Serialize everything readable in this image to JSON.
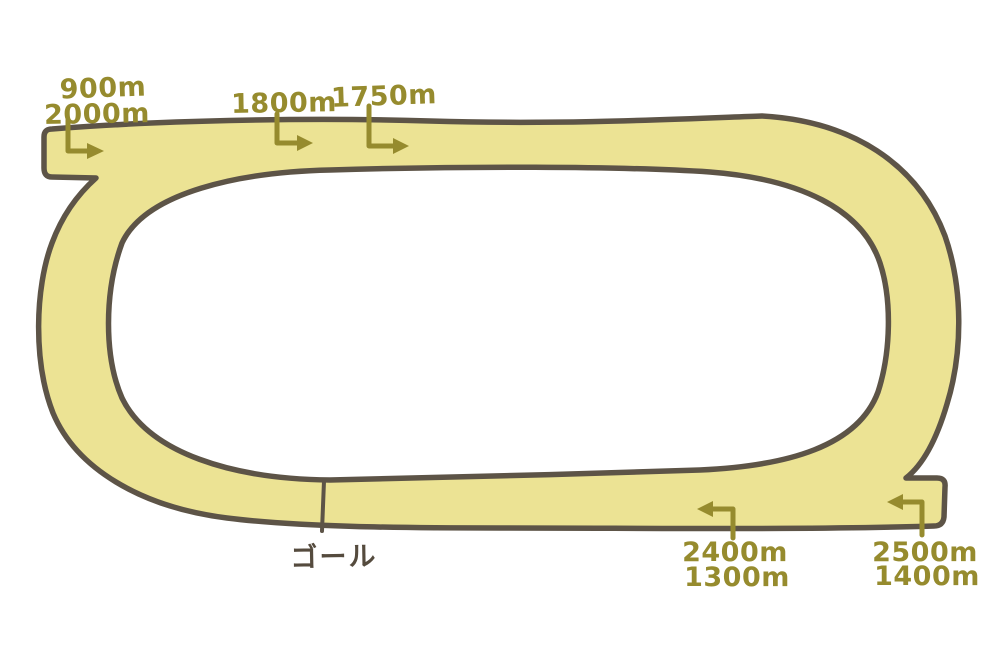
{
  "diagram": {
    "type": "racecourse-track",
    "background": "#ffffff",
    "track": {
      "fill": "#ece394",
      "outline": "#5d5447"
    },
    "marker_color": "#968b2e",
    "goal": {
      "label": "ゴール",
      "color": "#554b3e"
    },
    "start_markers": [
      {
        "id": "900m-2000m",
        "lines": [
          "900m",
          "2000m"
        ],
        "arrow_direction": "down-then-right"
      },
      {
        "id": "1800m",
        "lines": [
          "1800m"
        ],
        "arrow_direction": "down-then-right"
      },
      {
        "id": "1750m",
        "lines": [
          "1750m"
        ],
        "arrow_direction": "down-then-right"
      },
      {
        "id": "2400m-1300m",
        "lines": [
          "2400m",
          "1300m"
        ],
        "arrow_direction": "up-then-left"
      },
      {
        "id": "2500m-1400m",
        "lines": [
          "2500m",
          "1400m"
        ],
        "arrow_direction": "up-then-left"
      }
    ]
  }
}
